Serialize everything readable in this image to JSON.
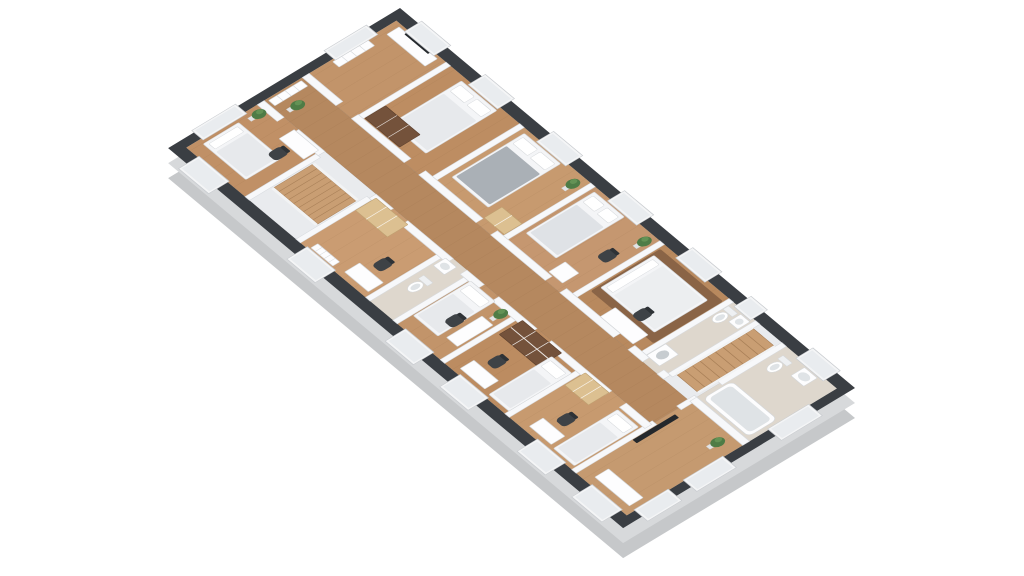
{
  "meta": {
    "description": "3D isometric floor plan rendering of one apartment level with bedrooms, bathrooms, a central corridor and two staircases on a white background"
  },
  "palette": {
    "background": "#ffffff",
    "wall_top": "#3a3e43",
    "wall_top_dark": "#2e3237",
    "extrude_near": "#c7c9cb",
    "extrude_far": "#d8dadc",
    "inner_wall": "#f7f8fa",
    "inner_wall_edge": "#d7dade",
    "wood_corridor": "#b5885f",
    "tile": "#ded7cd",
    "stair_floor": "#e9ebee",
    "stair_wood": "#c99e73",
    "stair_line": "#a87f57",
    "window_fill": "#f4f5f6",
    "window_inner": "#e9ecef",
    "window_frame": "#c9ccd0",
    "furn_white": "#f4f5f7",
    "furn_edge": "#d4d7da",
    "pillow": "#ffffff",
    "blanket_light": "#e7e9ec",
    "blanket_gray": "#aab0b6",
    "wood_dark": "#74523b",
    "wood_dark_edge": "#5d402d",
    "wood_light": "#dcc091",
    "wood_light_edge": "#bfa171",
    "chair": "#3e4246",
    "plant": "#4e7c46",
    "plant_light": "#639255",
    "pot": "#e2e4e6",
    "tv": "#24282c",
    "rug": "#876245",
    "plank_line": "rgba(90,50,20,0.10)",
    "fixture_inner": "#dfe3e6"
  },
  "projection": {
    "matrix": [
      0.455,
      0.38,
      -0.682,
      0.412,
      400,
      8
    ],
    "extrude_offsets": [
      [
        0,
        30,
        "#c6c8ca"
      ],
      [
        0,
        15,
        "#d7d9db"
      ]
    ]
  },
  "building": {
    "length": 1000,
    "width": 340,
    "outer_wall_thickness": 16
  },
  "rooms": [
    {
      "id": "lounge",
      "x": 16,
      "y": 16,
      "w": 114,
      "h": 138,
      "floor": "wood",
      "tint": "#c2946a"
    },
    {
      "id": "bedroom-1",
      "x": 130,
      "y": 16,
      "w": 162,
      "h": 138,
      "floor": "wood",
      "tint": "#bd8d62"
    },
    {
      "id": "bedroom-2",
      "x": 292,
      "y": 16,
      "w": 156,
      "h": 138,
      "floor": "wood",
      "tint": "#c79a6f"
    },
    {
      "id": "bedroom-3",
      "x": 448,
      "y": 16,
      "w": 152,
      "h": 138,
      "floor": "wood",
      "tint": "#c59770"
    },
    {
      "id": "bedroom-4",
      "x": 600,
      "y": 16,
      "w": 152,
      "h": 138,
      "floor": "wood",
      "tint": "#b8895e"
    },
    {
      "id": "bathroom-1",
      "x": 752,
      "y": 16,
      "w": 58,
      "h": 138,
      "floor": "tile",
      "tint": "#ded7cd"
    },
    {
      "id": "stairwell-2",
      "x": 810,
      "y": 16,
      "w": 58,
      "h": 138,
      "floor": "stair",
      "tint": "#e9ebee"
    },
    {
      "id": "bathroom-2",
      "x": 868,
      "y": 16,
      "w": 116,
      "h": 134,
      "floor": "tile",
      "tint": "#ded7cd"
    },
    {
      "id": "bedroom-5",
      "x": 868,
      "y": 150,
      "w": 116,
      "h": 174,
      "floor": "wood",
      "tint": "#c59a70"
    },
    {
      "id": "corridor",
      "x": 16,
      "y": 154,
      "w": 852,
      "h": 56,
      "floor": "wood",
      "tint": "#b5885f"
    },
    {
      "id": "bedroom-6",
      "x": 16,
      "y": 210,
      "w": 134,
      "h": 114,
      "floor": "wood",
      "tint": "#c09066"
    },
    {
      "id": "stairwell-1",
      "x": 150,
      "y": 210,
      "w": 112,
      "h": 114,
      "floor": "stair",
      "tint": "#e9ebee"
    },
    {
      "id": "bedroom-7",
      "x": 262,
      "y": 210,
      "w": 153,
      "h": 114,
      "floor": "wood",
      "tint": "#ca9c72"
    },
    {
      "id": "wc",
      "x": 415,
      "y": 210,
      "w": 60,
      "h": 114,
      "floor": "tile",
      "tint": "#ded7cd"
    },
    {
      "id": "bedroom-8",
      "x": 475,
      "y": 210,
      "w": 104,
      "h": 114,
      "floor": "wood",
      "tint": "#c2946a"
    },
    {
      "id": "bedroom-9",
      "x": 579,
      "y": 210,
      "w": 142,
      "h": 114,
      "floor": "wood",
      "tint": "#bc8c61"
    },
    {
      "id": "bedroom-10",
      "x": 721,
      "y": 210,
      "w": 147,
      "h": 114,
      "floor": "wood",
      "tint": "#c79a6f"
    }
  ],
  "interior_walls": [
    [
      125,
      16,
      10,
      128
    ],
    [
      287,
      16,
      10,
      128
    ],
    [
      443,
      16,
      10,
      128
    ],
    [
      595,
      16,
      10,
      128
    ],
    [
      747,
      16,
      10,
      128
    ],
    [
      805,
      16,
      10,
      128
    ],
    [
      145,
      220,
      10,
      104
    ],
    [
      257,
      220,
      10,
      104
    ],
    [
      410,
      220,
      10,
      104
    ],
    [
      470,
      220,
      10,
      104
    ],
    [
      574,
      220,
      10,
      104
    ],
    [
      716,
      220,
      10,
      104
    ],
    [
      863,
      16,
      10,
      94
    ],
    [
      863,
      144,
      10,
      26
    ],
    [
      863,
      206,
      10,
      118
    ],
    [
      868,
      144,
      116,
      10
    ],
    [
      16,
      144,
      74,
      10
    ],
    [
      124,
      144,
      116,
      10
    ],
    [
      272,
      144,
      126,
      10
    ],
    [
      430,
      144,
      120,
      10
    ],
    [
      582,
      144,
      118,
      10
    ],
    [
      732,
      144,
      32,
      10
    ],
    [
      796,
      144,
      14,
      10
    ],
    [
      16,
      210,
      44,
      10
    ],
    [
      92,
      210,
      58,
      10
    ],
    [
      262,
      210,
      38,
      10
    ],
    [
      332,
      210,
      100,
      10
    ],
    [
      462,
      210,
      38,
      10
    ],
    [
      532,
      210,
      84,
      10
    ],
    [
      648,
      210,
      132,
      10
    ],
    [
      812,
      210,
      56,
      10
    ]
  ],
  "windows": {
    "top": [
      [
        40,
        64
      ],
      [
        180,
        64
      ],
      [
        330,
        64
      ],
      [
        486,
        64
      ],
      [
        636,
        64
      ],
      [
        764,
        36
      ],
      [
        900,
        60
      ]
    ],
    "bottom": [
      [
        44,
        60
      ],
      [
        282,
        56
      ],
      [
        498,
        56
      ],
      [
        618,
        56
      ],
      [
        788,
        56
      ],
      [
        908,
        60
      ]
    ],
    "west": [
      [
        46,
        62
      ],
      [
        238,
        64
      ]
    ],
    "east": [
      [
        56,
        60
      ],
      [
        182,
        58
      ],
      [
        262,
        50
      ]
    ]
  },
  "furniture": [
    {
      "type": "sideboard",
      "room": "lounge",
      "x": 28,
      "y": 20,
      "w": 84,
      "h": 18
    },
    {
      "type": "tv",
      "room": "lounge",
      "x": 44,
      "y": 15,
      "w": 52,
      "h": 8
    },
    {
      "type": "shelf",
      "room": "lounge",
      "x": 20,
      "y": 60,
      "w": 14,
      "h": 52
    },
    {
      "type": "double-bed",
      "room": "bedroom-1",
      "x": 168,
      "y": 22,
      "w": 78,
      "h": 104,
      "dir": "v",
      "blanket": "#e7e9ec"
    },
    {
      "type": "wardrobe",
      "room": "bedroom-1",
      "x": 136,
      "y": 112,
      "w": 76,
      "h": 30,
      "c": "dark"
    },
    {
      "type": "double-bed",
      "room": "bedroom-2",
      "x": 306,
      "y": 22,
      "w": 80,
      "h": 106,
      "dir": "v",
      "blanket": "#aab0b6"
    },
    {
      "type": "dresser",
      "room": "bedroom-2",
      "x": 398,
      "y": 116,
      "w": 44,
      "h": 26
    },
    {
      "type": "plant",
      "room": "bedroom-2",
      "x": 428,
      "y": 32
    },
    {
      "type": "double-bed",
      "room": "bedroom-3",
      "x": 460,
      "y": 22,
      "w": 66,
      "h": 100,
      "dir": "v",
      "blanket": "#dfe2e6"
    },
    {
      "type": "cabinet",
      "room": "bedroom-3",
      "x": 540,
      "y": 118,
      "w": 30,
      "h": 24
    },
    {
      "type": "plant",
      "room": "bedroom-3",
      "x": 582,
      "y": 30
    },
    {
      "type": "chair",
      "room": "bedroom-3",
      "x": 560,
      "y": 66
    },
    {
      "type": "rug",
      "room": "bedroom-4",
      "x": 608,
      "y": 24,
      "w": 138,
      "h": 102
    },
    {
      "type": "double-bed",
      "room": "bedroom-4",
      "x": 612,
      "y": 36,
      "w": 118,
      "h": 78,
      "dir": "h",
      "blanket": "#eceef0"
    },
    {
      "type": "desk",
      "room": "bedroom-4",
      "x": 656,
      "y": 122,
      "w": 72,
      "h": 22
    },
    {
      "type": "chair",
      "room": "bedroom-4",
      "x": 682,
      "y": 96
    },
    {
      "type": "toilet",
      "room": "bathroom-1",
      "x": 758,
      "y": 24
    },
    {
      "type": "sink",
      "room": "bathroom-1",
      "x": 782,
      "y": 22,
      "w": 20,
      "h": 18
    },
    {
      "type": "washer",
      "room": "bathroom-1",
      "x": 758,
      "y": 116,
      "w": 28,
      "h": 28
    },
    {
      "type": "stairs",
      "room": "stairwell-2",
      "x": 816,
      "y": 26,
      "w": 44,
      "h": 112,
      "dir": "v"
    },
    {
      "type": "toilet",
      "room": "bathroom-2",
      "x": 884,
      "y": 28
    },
    {
      "type": "sink",
      "room": "bathroom-2",
      "x": 922,
      "y": 22,
      "w": 28,
      "h": 20
    },
    {
      "type": "tub",
      "room": "bathroom-2",
      "x": 876,
      "y": 98,
      "w": 100,
      "h": 42
    },
    {
      "type": "tv-wall",
      "room": "bedroom-5",
      "x": 874,
      "y": 180,
      "w": 9,
      "h": 62
    },
    {
      "type": "sideboard",
      "room": "bedroom-5",
      "x": 896,
      "y": 292,
      "w": 76,
      "h": 20
    },
    {
      "type": "plant",
      "room": "bedroom-5",
      "x": 956,
      "y": 172
    },
    {
      "type": "shelf",
      "room": "corridor",
      "x": 20,
      "y": 158,
      "w": 14,
      "h": 48
    },
    {
      "type": "plant",
      "room": "corridor",
      "x": 54,
      "y": 186
    },
    {
      "type": "single-bed",
      "room": "bedroom-6",
      "x": 26,
      "y": 254,
      "w": 94,
      "h": 52,
      "dir": "h",
      "blanket": "#e7e9ec"
    },
    {
      "type": "desk",
      "room": "bedroom-6",
      "x": 88,
      "y": 214,
      "w": 54,
      "h": 22
    },
    {
      "type": "chair",
      "room": "bedroom-6",
      "x": 100,
      "y": 242
    },
    {
      "type": "plant",
      "room": "bedroom-6",
      "x": 32,
      "y": 228
    },
    {
      "type": "stairs",
      "room": "stairwell-1",
      "x": 158,
      "y": 234,
      "w": 96,
      "h": 56,
      "dir": "h"
    },
    {
      "type": "wardrobe",
      "room": "bedroom-7",
      "x": 268,
      "y": 214,
      "w": 70,
      "h": 30,
      "c": "light"
    },
    {
      "type": "desk",
      "room": "bedroom-7",
      "x": 352,
      "y": 294,
      "w": 52,
      "h": 22
    },
    {
      "type": "chair",
      "room": "bedroom-7",
      "x": 366,
      "y": 266
    },
    {
      "type": "radiator",
      "room": "bedroom-7",
      "x": 284,
      "y": 310,
      "w": 48,
      "h": 10
    },
    {
      "type": "sink",
      "room": "wc",
      "x": 424,
      "y": 216,
      "w": 24,
      "h": 18
    },
    {
      "type": "toilet",
      "room": "wc",
      "x": 430,
      "y": 252
    },
    {
      "type": "single-bed",
      "room": "bedroom-8",
      "x": 482,
      "y": 218,
      "w": 54,
      "h": 84,
      "dir": "v",
      "blanket": "#e7e9ec"
    },
    {
      "type": "desk",
      "room": "bedroom-8",
      "x": 546,
      "y": 244,
      "w": 24,
      "h": 52
    },
    {
      "type": "chair",
      "room": "bedroom-8",
      "x": 518,
      "y": 262
    },
    {
      "type": "plant",
      "room": "bedroom-8",
      "x": 560,
      "y": 226
    },
    {
      "type": "bookcase",
      "room": "bedroom-9",
      "x": 590,
      "y": 214,
      "w": 86,
      "h": 34
    },
    {
      "type": "desk",
      "room": "bedroom-9",
      "x": 606,
      "y": 296,
      "w": 54,
      "h": 20
    },
    {
      "type": "chair",
      "room": "bedroom-9",
      "x": 620,
      "y": 268
    },
    {
      "type": "single-bed",
      "room": "bedroom-9",
      "x": 672,
      "y": 226,
      "w": 44,
      "h": 92,
      "dir": "v",
      "blanket": "#e7e9ec"
    },
    {
      "type": "wardrobe",
      "room": "bedroom-10",
      "x": 728,
      "y": 214,
      "w": 52,
      "h": 30,
      "c": "light"
    },
    {
      "type": "desk",
      "room": "bedroom-10",
      "x": 758,
      "y": 296,
      "w": 48,
      "h": 20
    },
    {
      "type": "chair",
      "room": "bedroom-10",
      "x": 772,
      "y": 268
    },
    {
      "type": "single-bed",
      "room": "bedroom-10",
      "x": 814,
      "y": 224,
      "w": 46,
      "h": 94,
      "dir": "v",
      "blanket": "#e7e9ec"
    }
  ]
}
